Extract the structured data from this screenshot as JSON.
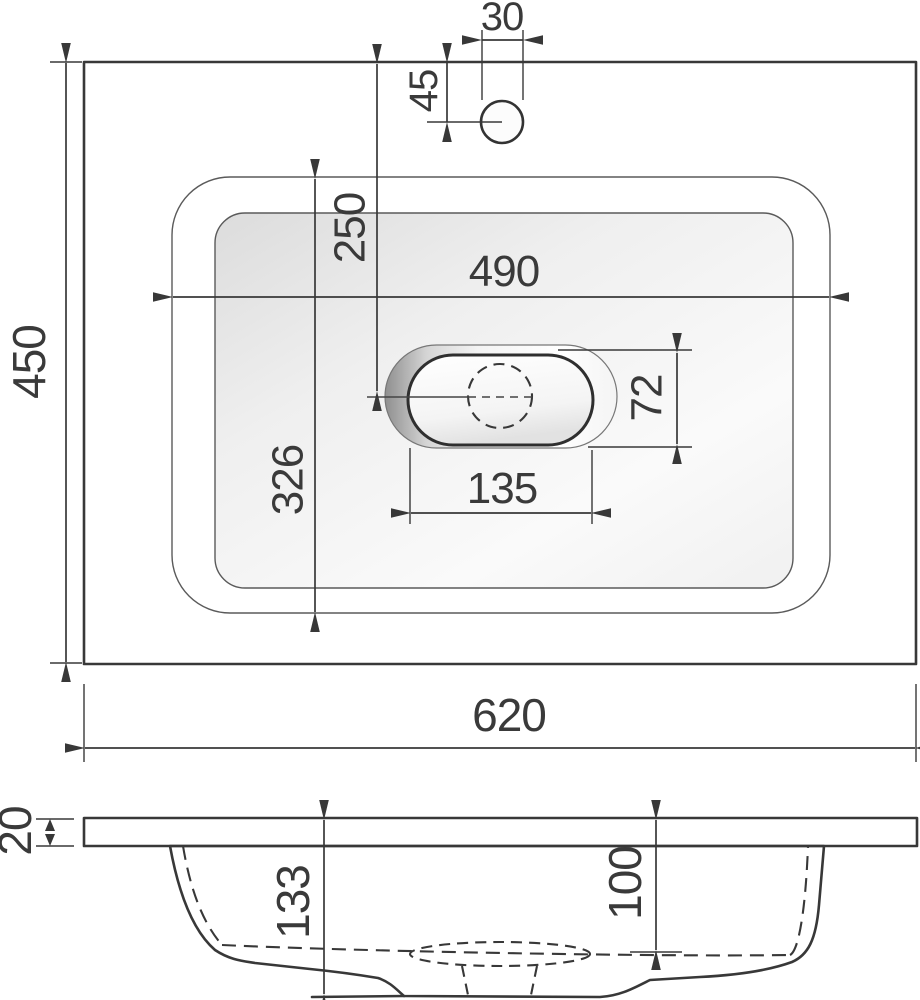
{
  "top_view": {
    "dims": {
      "faucet_hole_diameter": "30",
      "faucet_setback": "45",
      "overall_depth": "450",
      "drain_setback": "250",
      "bowl_width": "490",
      "bowl_depth": "326",
      "drain_recess_depth": "72",
      "drain_recess_width": "135",
      "overall_width": "620"
    }
  },
  "section_view": {
    "dims": {
      "slab_thickness": "20",
      "bowl_total_height": "133",
      "bowl_inner_depth": "100"
    }
  },
  "style": {
    "line_color": "#383838",
    "countertop_fill": "#e2e2e2",
    "slab_fill": "#f3f3f3",
    "bowl_section_fill": "#c9c9c9",
    "background": "#ffffff"
  }
}
